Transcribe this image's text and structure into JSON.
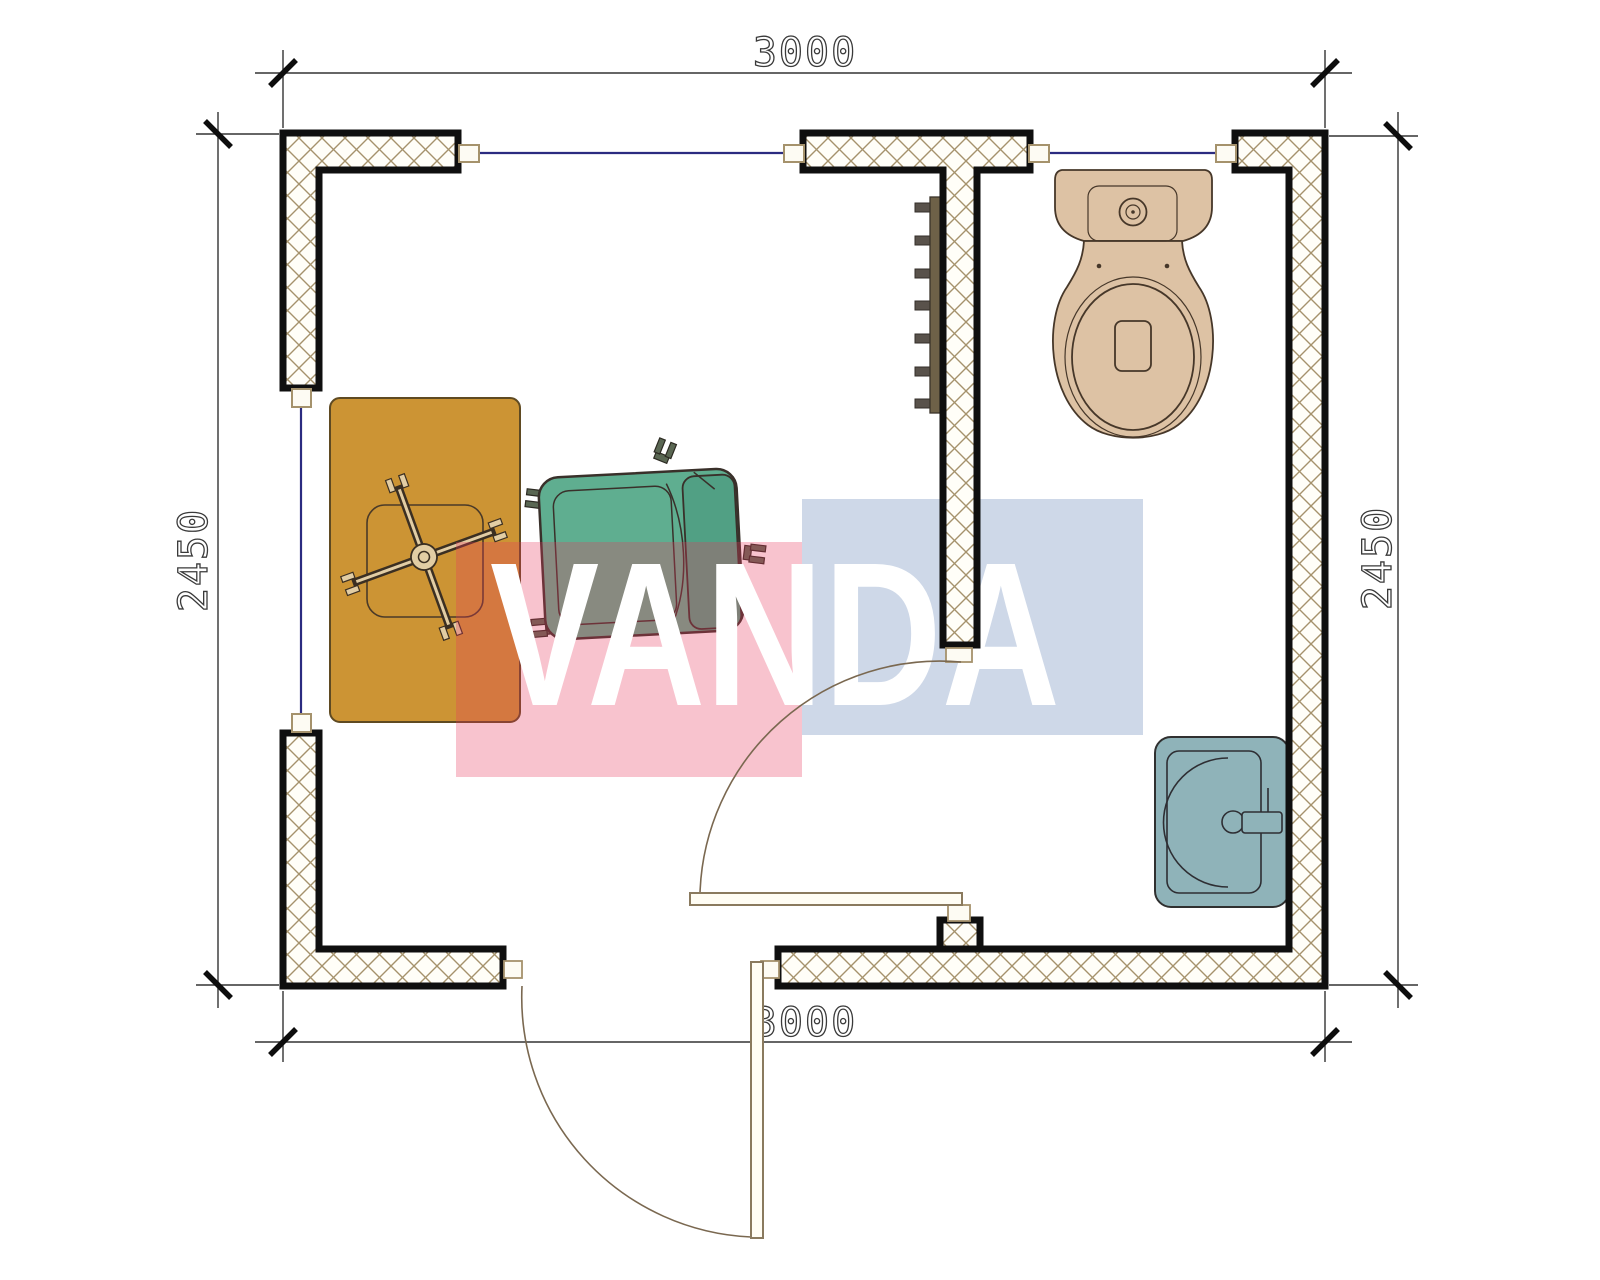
{
  "plan": {
    "title": "Cabin floor plan 3000 x 2450 with bathroom",
    "watermark": {
      "text": "VANDA",
      "text_color": "#ffffff",
      "red_color": "rgba(231,56,92,0.30)",
      "blue_color": "rgba(92,125,178,0.30)"
    },
    "dimensions": {
      "top": "3000",
      "bottom": "3000",
      "left": "2450",
      "right": "2450"
    },
    "colors": {
      "wall_outline": "#0f0f0f",
      "hatch": "#a5926c",
      "window_glass": "#2b2b80",
      "desk": "#cc9434",
      "desk_outline": "#5f4a22",
      "chair_base": "#e2cda4",
      "armchair": "#5fae90",
      "armchair_back": "#51a084",
      "armchair_foot": "#5a6753",
      "toilet": "#ddc2a4",
      "sink": "#8fb3b9",
      "radiator": "#6e6148",
      "radiator_fin": "#59524b",
      "door_leaf": "#fffdf4",
      "door_arc": "#7a6850",
      "dim_text": "#3a3a3a"
    },
    "fixture_names": [
      "desk",
      "office-chair",
      "armchair",
      "radiator",
      "toilet",
      "sink",
      "interior-door",
      "exterior-door",
      "window"
    ]
  }
}
